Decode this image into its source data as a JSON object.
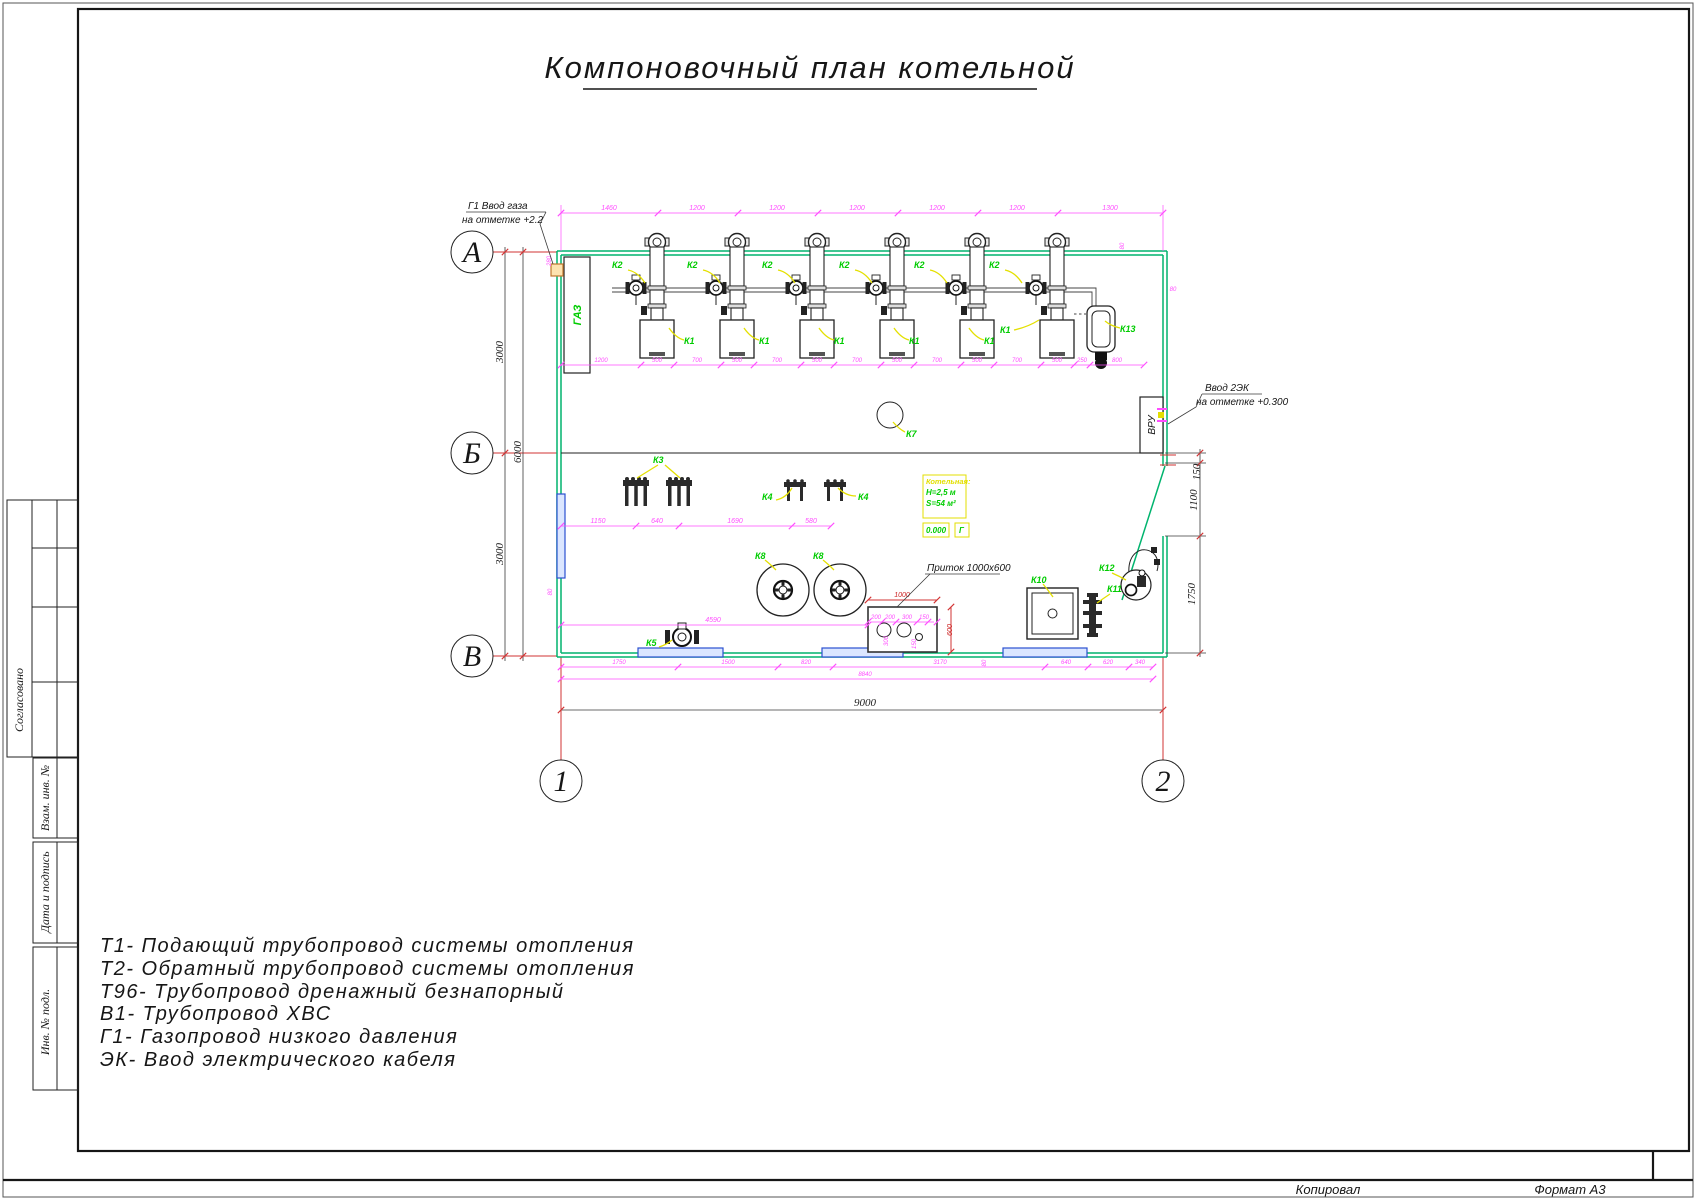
{
  "title": "Компоновочный план котельной",
  "footer": {
    "copy": "Копировал",
    "format": "Формат А3"
  },
  "stamp": {
    "approved": "Согласовано",
    "vzam": "Взам. инв. №",
    "date_sign": "Дата и подпись",
    "inv": "Инв. № подл."
  },
  "legend": [
    "Т1- Подающий трубопровод системы отопления",
    "Т2- Обратный трубопровод системы отопления",
    "Т96- Трубопровод дренажный безнапорный",
    "В1- Трубопровод ХВС",
    "Г1- Газопровод низкого давления",
    "ЭК- Ввод электрического кабеля"
  ],
  "axes": {
    "row_a": "А",
    "row_b": "Б",
    "row_v": "В",
    "col_1": "1",
    "col_2": "2"
  },
  "labels": {
    "k1": "К1",
    "k2": "К2",
    "k3": "К3",
    "k4": "К4",
    "k5": "К5",
    "k7": "К7",
    "k8": "К8",
    "k10": "К10",
    "k11": "К11",
    "k12": "К12",
    "k13": "К13",
    "gas_cabinet": "ГАЗ",
    "vru": "ВРУ"
  },
  "room": {
    "name": "Котельная:",
    "height": "Н=2,5 м",
    "area": "S=54 м²",
    "level": "0.000",
    "g_mark": "Г"
  },
  "annotations": {
    "gas_line1": "Г1 Ввод газа",
    "gas_line2": "на отметке +2.2",
    "elec_line1": "Ввод 2ЭК",
    "elec_line2": "на отметке +0.300",
    "supply_air": "Приток 1000х600"
  },
  "dims": {
    "top": [
      "1460",
      "1200",
      "1200",
      "1200",
      "1200",
      "1200",
      "1300"
    ],
    "under": [
      "1200",
      "500",
      "700",
      "500",
      "700",
      "500",
      "700",
      "500",
      "700",
      "500",
      "700",
      "500",
      "250",
      "800"
    ],
    "left": [
      "3000",
      "6000",
      "3000"
    ],
    "mid": [
      "1150",
      "640",
      "1690",
      "580"
    ],
    "right": [
      "150",
      "1100",
      "1750"
    ],
    "d4590": "4590",
    "bottom1": [
      "1750",
      "1500",
      "820",
      "3170",
      "640",
      "620",
      "340"
    ],
    "d8840": "8840",
    "d9000": "9000",
    "pritok_w": "1000",
    "pritok_h": "600",
    "pritok_inner": [
      "200",
      "200",
      "300",
      "150"
    ],
    "pritok_inner_v": [
      "300",
      "150"
    ],
    "d80": "80",
    "d280": "280"
  },
  "colors": {
    "wall_green": "#00b46e",
    "dim_magenta": "#ff4dff",
    "label_green": "#00cc00",
    "leader_yellow": "#e4e000",
    "axis_red": "#d23333",
    "window_blue": "#2b50d0",
    "marker_yellow": "#e3df00"
  }
}
